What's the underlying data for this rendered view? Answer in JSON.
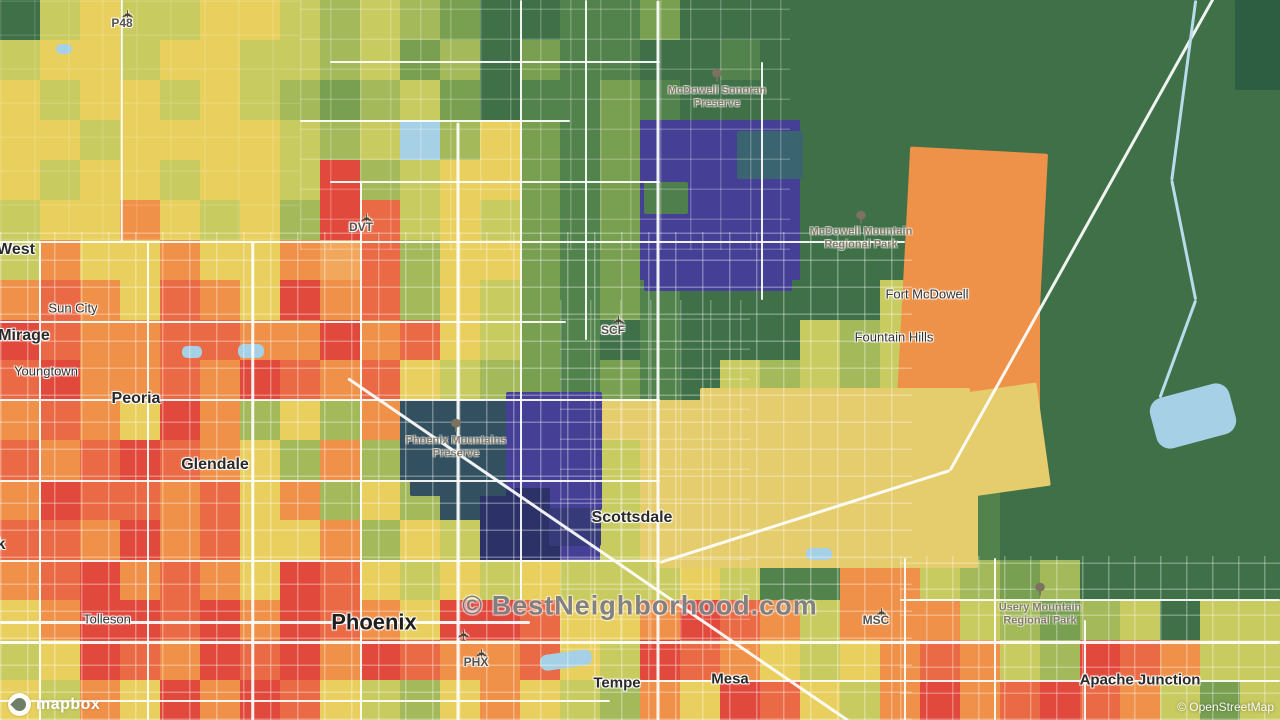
{
  "watermark": {
    "text": "© BestNeighborhood.com"
  },
  "attribution": {
    "mapbox_label": "mapbox",
    "osm_label": "© OpenStreetMap"
  },
  "map": {
    "palette": {
      "R": "#e2493d",
      "r": "#ea6a45",
      "O": "#f09149",
      "o": "#f2a85c",
      "Y": "#e9d05e",
      "G": "#c8cb60",
      "g": "#a3b95a",
      "M": "#79a050",
      "D": "#53834c",
      "F": "#3f7048",
      "E": "#2e5e41",
      "P": "#453f96",
      "N": "#2c3168",
      "S": "#32505f",
      "T": "#3a6470",
      "K": "#e5cc6c",
      "W": "#a5d0e6"
    },
    "grid": {
      "cols": 32,
      "rows": 18,
      "cell": 40,
      "rows_data": [
        "FGYGGYYGgGgMFFDDMFFFFFFFFFFFFFEF",
        "GYYGYYGGgGMgFMDDFFDFFFFFFFFFFFFF",
        "YGYYGYGgMgGMFDDMDFFFFFFFFFFFFFFF",
        "YYGYYYYGgGWgYMDMPPPPFFFFFFFFFFFF",
        "YGYYGYYGRgGYYMDMPPPPFFFOOOFFFFFF",
        "GYYOYGYgRrGYGMDMPPPPFFFOOOFFFFFF",
        "GOYYOYYOorgYYMDMPPPPFFFOOOFFFFFF",
        "OrOYrOYROrgYGMDMDFFFFFGOOOFFFFFF",
        "RrOOrrOOROrYGMDFDFFFGgGOOOFFFFFF",
        "rROOrORrOrYGgMDMDFGgGgGOOOFFFFWF",
        "OrOYROgYgOSSSPPKKKKKKKKKKOFFFWWF",
        "rOrRrOYgOgSSSPPGKKKKKKKKKFFFFFFF",
        "ORrrOrYOgYgSNNPGKKKKKKKKDFFFFFFF",
        "rrOROrYYOgYGNNPGKKKKKKKGDFFFFFFF",
        "OrROrOYRrYGYGYGGGYGDDOOGgMgFFFFF",
        "YORRrRORrOYRRrYYORrOGOOOGgMgGFGG",
        "GYRrORrRORrOOrYGRrOYGYOrOGgRrOGG",
        "YGOYRORrYGgYOYGgOYRrYGOROrRrOGMG"
      ]
    },
    "regions": [
      {
        "x": 1045,
        "y": 0,
        "w": 235,
        "h": 552,
        "c": "#3f7048"
      },
      {
        "x": 1235,
        "y": 0,
        "w": 45,
        "h": 90,
        "c": "#2e5e41"
      },
      {
        "x": 0,
        "y": 0,
        "w": 34,
        "h": 36,
        "c": "#3f7048"
      },
      {
        "x": 644,
        "y": 139,
        "w": 148,
        "h": 152,
        "c": "#453f96"
      },
      {
        "x": 737,
        "y": 131,
        "w": 66,
        "h": 48,
        "c": "#3a6470"
      },
      {
        "x": 644,
        "y": 182,
        "w": 44,
        "h": 32,
        "c": "#4f7f4c"
      },
      {
        "x": 903,
        "y": 150,
        "w": 138,
        "h": 272,
        "c": "#ef9249",
        "rot": 3
      },
      {
        "x": 700,
        "y": 388,
        "w": 270,
        "h": 32,
        "c": "#e5cc6c"
      },
      {
        "x": 654,
        "y": 402,
        "w": 324,
        "h": 166,
        "c": "#e5cc6c"
      },
      {
        "x": 958,
        "y": 388,
        "w": 86,
        "h": 104,
        "c": "#e5cc6c",
        "rot": -8
      },
      {
        "x": 410,
        "y": 404,
        "w": 110,
        "h": 92,
        "c": "#32505f"
      },
      {
        "x": 506,
        "y": 392,
        "w": 96,
        "h": 118,
        "c": "#453f96"
      },
      {
        "x": 520,
        "y": 470,
        "w": 78,
        "h": 56,
        "c": "#453f96"
      },
      {
        "x": 506,
        "y": 488,
        "w": 44,
        "h": 58,
        "c": "#2c3168"
      },
      {
        "x": 549,
        "y": 508,
        "w": 52,
        "h": 38,
        "c": "#363a78"
      },
      {
        "x": 1152,
        "y": 390,
        "w": 82,
        "h": 52,
        "c": "#a5d0e6",
        "r": 14,
        "rot": -15
      },
      {
        "x": 540,
        "y": 652,
        "w": 52,
        "h": 16,
        "c": "#a5d0e6",
        "r": 7,
        "rot": -8
      },
      {
        "x": 404,
        "y": 124,
        "w": 24,
        "h": 14,
        "c": "#a5d0e6",
        "r": 6
      },
      {
        "x": 56,
        "y": 44,
        "w": 16,
        "h": 10,
        "c": "#a5d0e6",
        "r": 5
      },
      {
        "x": 806,
        "y": 548,
        "w": 26,
        "h": 12,
        "c": "#a5d0e6",
        "r": 5
      },
      {
        "x": 182,
        "y": 346,
        "w": 20,
        "h": 12,
        "c": "#a5d0e6",
        "r": 5
      },
      {
        "x": 238,
        "y": 344,
        "w": 26,
        "h": 14,
        "c": "#a5d0e6",
        "r": 6
      }
    ],
    "street_grids": [
      {
        "x": 0,
        "y": 232,
        "w": 912,
        "h": 488,
        "o": 0.32,
        "s": 27
      },
      {
        "x": 300,
        "y": 0,
        "w": 490,
        "h": 250,
        "o": 0.22,
        "s": 30
      },
      {
        "x": 560,
        "y": 300,
        "w": 190,
        "h": 350,
        "o": 0.25,
        "s": 30
      },
      {
        "x": 900,
        "y": 556,
        "w": 380,
        "h": 164,
        "o": 0.3,
        "s": 26
      },
      {
        "x": 0,
        "y": 0,
        "w": 300,
        "h": 240,
        "o": 0.12,
        "s": 34
      }
    ],
    "roads": [
      {
        "x1": 0,
        "y1": 242,
        "x2": 905,
        "y2": 242,
        "w": 2.5
      },
      {
        "x1": 0,
        "y1": 322,
        "x2": 566,
        "y2": 322,
        "w": 2
      },
      {
        "x1": 0,
        "y1": 400,
        "x2": 660,
        "y2": 400,
        "w": 2.5
      },
      {
        "x1": 0,
        "y1": 481,
        "x2": 660,
        "y2": 481,
        "w": 2
      },
      {
        "x1": 0,
        "y1": 561,
        "x2": 660,
        "y2": 561,
        "w": 2
      },
      {
        "x1": 0,
        "y1": 622,
        "x2": 530,
        "y2": 622,
        "w": 3
      },
      {
        "x1": 0,
        "y1": 642,
        "x2": 1280,
        "y2": 642,
        "w": 3
      },
      {
        "x1": 600,
        "y1": 681,
        "x2": 1280,
        "y2": 681,
        "w": 2.5
      },
      {
        "x1": 0,
        "y1": 701,
        "x2": 610,
        "y2": 701,
        "w": 2
      },
      {
        "x1": 300,
        "y1": 121,
        "x2": 570,
        "y2": 121,
        "w": 2
      },
      {
        "x1": 330,
        "y1": 182,
        "x2": 660,
        "y2": 182,
        "w": 2
      },
      {
        "x1": 330,
        "y1": 62,
        "x2": 660,
        "y2": 62,
        "w": 2
      },
      {
        "x1": 900,
        "y1": 600,
        "x2": 1280,
        "y2": 600,
        "w": 2
      },
      {
        "x1": 40,
        "y1": 242,
        "x2": 40,
        "y2": 720,
        "w": 2
      },
      {
        "x1": 148,
        "y1": 242,
        "x2": 148,
        "y2": 720,
        "w": 2
      },
      {
        "x1": 253,
        "y1": 242,
        "x2": 253,
        "y2": 720,
        "w": 2.5
      },
      {
        "x1": 361,
        "y1": 182,
        "x2": 361,
        "y2": 720,
        "w": 2
      },
      {
        "x1": 458,
        "y1": 122,
        "x2": 458,
        "y2": 720,
        "w": 3
      },
      {
        "x1": 521,
        "y1": 0,
        "x2": 521,
        "y2": 600,
        "w": 2
      },
      {
        "x1": 586,
        "y1": 0,
        "x2": 586,
        "y2": 340,
        "w": 2
      },
      {
        "x1": 658,
        "y1": 0,
        "x2": 658,
        "y2": 720,
        "w": 3
      },
      {
        "x1": 762,
        "y1": 62,
        "x2": 762,
        "y2": 300,
        "w": 2
      },
      {
        "x1": 905,
        "y1": 558,
        "x2": 905,
        "y2": 720,
        "w": 2
      },
      {
        "x1": 995,
        "y1": 558,
        "x2": 995,
        "y2": 720,
        "w": 2
      },
      {
        "x1": 1085,
        "y1": 620,
        "x2": 1085,
        "y2": 720,
        "w": 2
      },
      {
        "x1": 122,
        "y1": 0,
        "x2": 122,
        "y2": 242,
        "w": 1.5
      },
      {
        "x1": 348,
        "y1": 378,
        "x2": 848,
        "y2": 720,
        "w": 3
      },
      {
        "x1": 950,
        "y1": 470,
        "x2": 1215,
        "y2": -5,
        "w": 3
      },
      {
        "x1": 660,
        "y1": 562,
        "x2": 950,
        "y2": 470,
        "w": 3
      },
      {
        "x1": 1196,
        "y1": 0,
        "x2": 1172,
        "y2": 180,
        "w": 2.5,
        "c": "#b8dcec"
      },
      {
        "x1": 1172,
        "y1": 180,
        "x2": 1196,
        "y2": 300,
        "w": 2.5,
        "c": "#b8dcec"
      },
      {
        "x1": 1196,
        "y1": 300,
        "x2": 1160,
        "y2": 398,
        "w": 2.5,
        "c": "#b8dcec"
      }
    ],
    "labels": [
      {
        "name": "airport-p48",
        "text": "P48",
        "x": 122,
        "y": 24,
        "cls": "poi"
      },
      {
        "name": "mcdowell-sonoran-preserve",
        "lines": [
          "McDowell Sonoran",
          "Preserve"
        ],
        "x": 717,
        "y": 97,
        "cls": "park"
      },
      {
        "name": "mcdowell-mountain-regional-park",
        "lines": [
          "McDowell Mountain",
          "Regional Park"
        ],
        "x": 861,
        "y": 238,
        "cls": "park"
      },
      {
        "name": "fort-mcdowell",
        "text": "Fort McDowell",
        "x": 927,
        "y": 295,
        "cls": "town"
      },
      {
        "name": "fountain-hills",
        "text": "Fountain Hills",
        "x": 894,
        "y": 338,
        "cls": "town"
      },
      {
        "name": "sun-city-west",
        "text": "West",
        "x": 16,
        "y": 250,
        "cls": "city"
      },
      {
        "name": "sun-city",
        "text": "Sun City",
        "x": 73,
        "y": 309,
        "cls": "town"
      },
      {
        "name": "el-mirage",
        "text": "Mirage",
        "x": 24,
        "y": 336,
        "cls": "city"
      },
      {
        "name": "youngtown",
        "text": "Youngtown",
        "x": 46,
        "y": 372,
        "cls": "town"
      },
      {
        "name": "peoria",
        "text": "Peoria",
        "x": 136,
        "y": 399,
        "cls": "city"
      },
      {
        "name": "glendale",
        "text": "Glendale",
        "x": 215,
        "y": 465,
        "cls": "city"
      },
      {
        "name": "litchfield-park",
        "text": "Park",
        "x": -12,
        "y": 545,
        "cls": "city"
      },
      {
        "name": "tolleson",
        "text": "Tolleson",
        "x": 107,
        "y": 620,
        "cls": "town"
      },
      {
        "name": "phoenix",
        "text": "Phoenix",
        "x": 374,
        "y": 622,
        "cls": "city-major"
      },
      {
        "name": "scottsdale",
        "text": "Scottsdale",
        "x": 632,
        "y": 518,
        "cls": "city"
      },
      {
        "name": "tempe",
        "text": "Tempe",
        "x": 617,
        "y": 683,
        "cls": "city-sm"
      },
      {
        "name": "mesa",
        "text": "Mesa",
        "x": 730,
        "y": 679,
        "cls": "city-sm"
      },
      {
        "name": "apache-junction",
        "text": "Apache Junction",
        "x": 1140,
        "y": 680,
        "cls": "city-sm"
      },
      {
        "name": "airport-dvt",
        "text": "DVT",
        "x": 361,
        "y": 228,
        "cls": "poi"
      },
      {
        "name": "airport-scf",
        "text": "SCF",
        "x": 613,
        "y": 331,
        "cls": "poi"
      },
      {
        "name": "airport-phx",
        "text": "PHX",
        "x": 476,
        "y": 663,
        "cls": "poi"
      },
      {
        "name": "airport-msc",
        "text": "MSC",
        "x": 876,
        "y": 621,
        "cls": "poi"
      },
      {
        "name": "phoenix-mountains-preserve",
        "lines": [
          "Phoenix Mountains",
          "Preserve"
        ],
        "x": 456,
        "y": 447,
        "cls": "park"
      },
      {
        "name": "usery-mountain-regional-park",
        "lines": [
          "Usery Mountain",
          "Regional Park"
        ],
        "x": 1040,
        "y": 614,
        "cls": "park"
      }
    ],
    "icons": [
      {
        "type": "plane",
        "x": 122,
        "y": 8
      },
      {
        "type": "plane",
        "x": 361,
        "y": 212
      },
      {
        "type": "plane",
        "x": 613,
        "y": 314
      },
      {
        "type": "plane",
        "x": 458,
        "y": 628
      },
      {
        "type": "plane",
        "x": 476,
        "y": 647
      },
      {
        "type": "plane",
        "x": 876,
        "y": 606
      },
      {
        "type": "tree",
        "x": 717,
        "y": 78
      },
      {
        "type": "tree",
        "x": 861,
        "y": 220
      },
      {
        "type": "tree",
        "x": 456,
        "y": 428
      },
      {
        "type": "tree",
        "x": 1040,
        "y": 592
      }
    ]
  }
}
